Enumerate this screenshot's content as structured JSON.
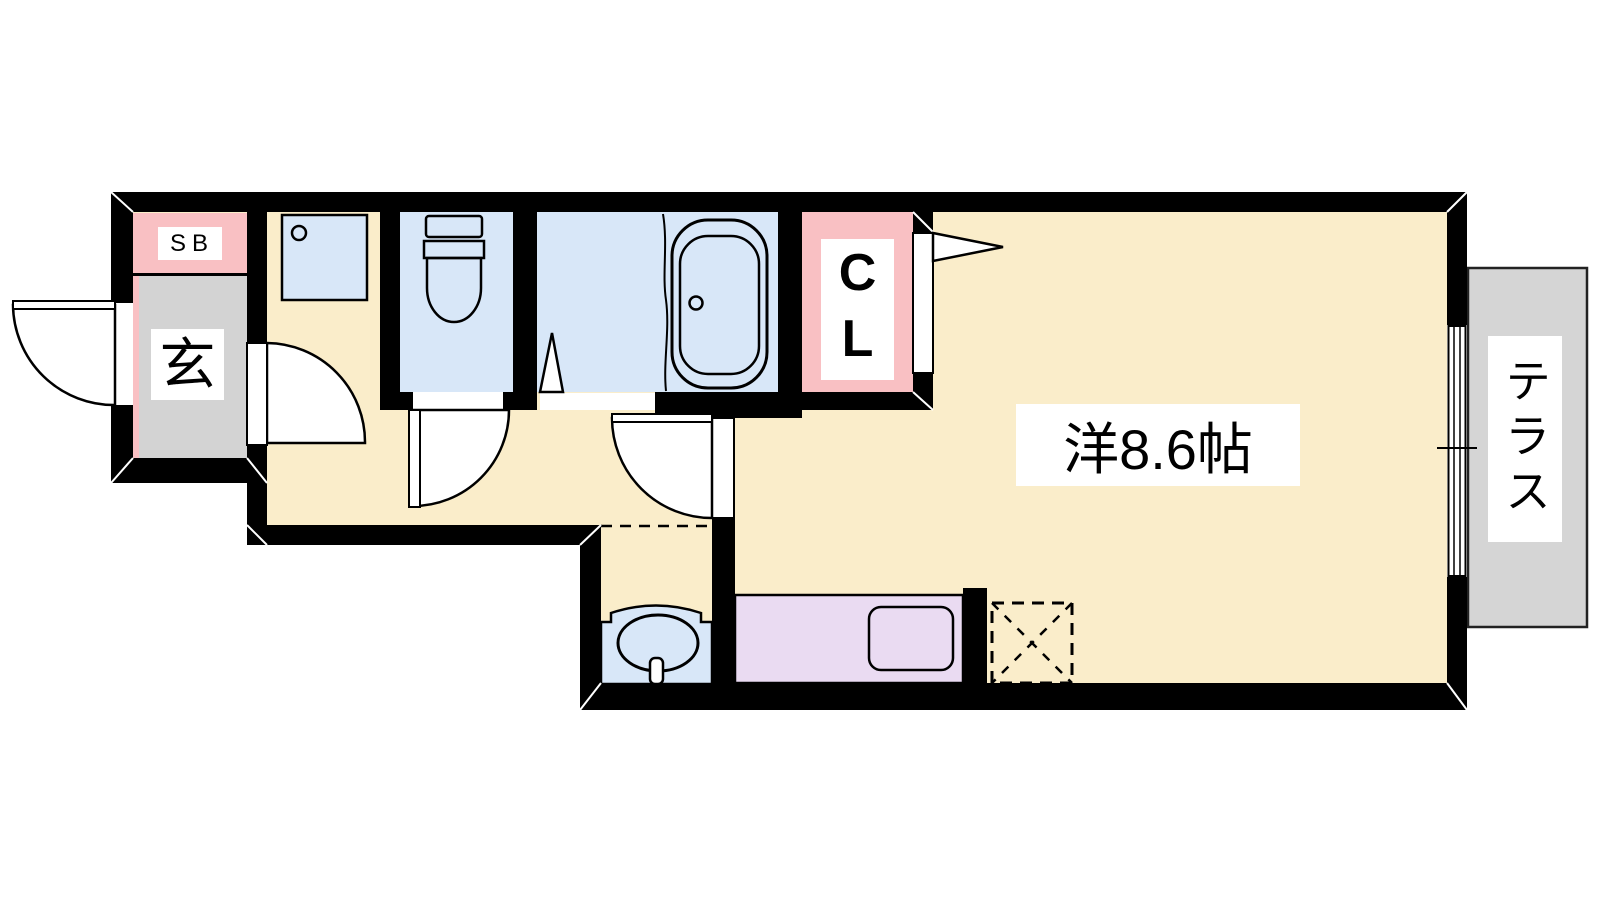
{
  "plan": {
    "labels": {
      "shoe_box": "SB",
      "entrance": "玄",
      "closet": "CL",
      "main_room": "洋8.6帖",
      "terrace": "テラス"
    },
    "colors": {
      "background": "#FFFFFF",
      "wall": "#000000",
      "flooring_cream": "#FAEDCA",
      "wet_area_blue": "#D8E7F8",
      "accent_pink": "#F9C0C3",
      "entrance_gray": "#D3D3D3",
      "terrace_gray": "#D5D5D5",
      "kitchen_lavender": "#EADBF2"
    }
  }
}
